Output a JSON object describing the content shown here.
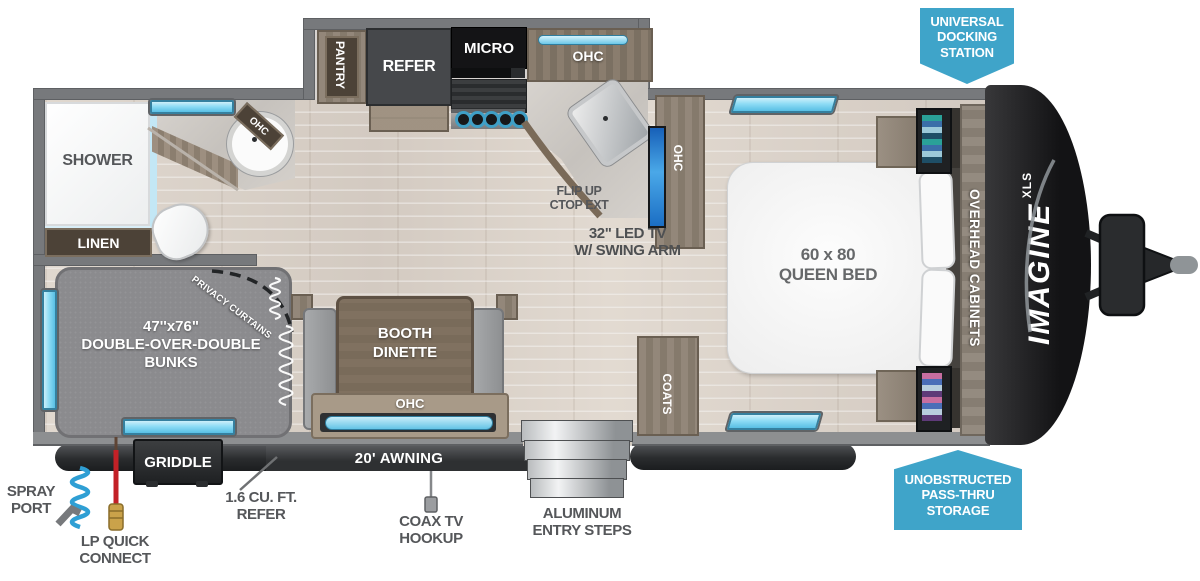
{
  "colors": {
    "badge_blue": "#3fa4c9",
    "window_blue": "#8edcf5",
    "tv_blue": "#2f8de0",
    "lp_red": "#c32127",
    "hose_blue": "#2f9fd4",
    "wall_gray": "#77797c"
  },
  "badges": {
    "docking": [
      "UNIVERSAL",
      "DOCKING",
      "STATION"
    ],
    "storage": [
      "UNOBSTRUCTED",
      "PASS-THRU",
      "STORAGE"
    ]
  },
  "exterior": {
    "spray_port": [
      "SPRAY",
      "PORT"
    ],
    "lp_quick_connect": [
      "LP QUICK",
      "CONNECT"
    ],
    "outside_refer": [
      "1.6 CU. FT.",
      "REFER"
    ],
    "griddle": "GRIDDLE",
    "awning": "20' AWNING",
    "coax": [
      "COAX TV",
      "HOOKUP"
    ],
    "entry_steps": [
      "ALUMINUM",
      "ENTRY STEPS"
    ]
  },
  "bathroom": {
    "shower": "SHOWER",
    "linen": "LINEN",
    "ohc": "OHC"
  },
  "kitchen": {
    "pantry": "PANTRY",
    "refer": "REFER",
    "micro": "MICRO",
    "ohc": "OHC",
    "flip_ctop": [
      "FLIP UP",
      "CTOP EXT"
    ],
    "tv": [
      "32\" LED TV",
      "W/ SWING ARM"
    ],
    "tv_ohc": "OHC"
  },
  "living": {
    "bunks": [
      "47''x76\"",
      "DOUBLE-OVER-DOUBLE",
      "BUNKS"
    ],
    "privacy_curtains": "PRIVACY CURTAINS",
    "dinette": [
      "BOOTH",
      "DINETTE"
    ],
    "dinette_ohc": "OHC",
    "coats": "COATS"
  },
  "bedroom": {
    "bed": [
      "60 x 80",
      "QUEEN BED"
    ],
    "overhead": "OVERHEAD CABINETS"
  },
  "brand": {
    "name": "IMAGINE",
    "series": "XLS"
  }
}
